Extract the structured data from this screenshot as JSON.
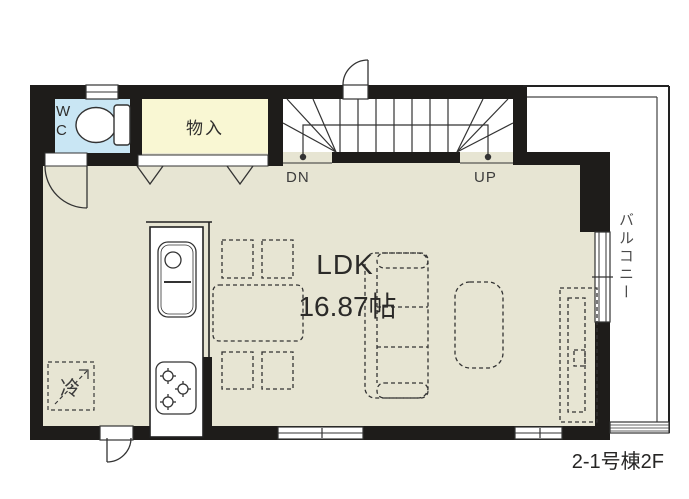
{
  "plan": {
    "unit_label": "2-1号棟2F",
    "rooms": {
      "wc": "WC",
      "storage": "物入",
      "ldk_name": "LDK",
      "ldk_size": "16.87帖",
      "balcony": "バルコニー",
      "refrigerator": "冷"
    },
    "stairs": {
      "down": "DN",
      "up": "UP"
    },
    "colors": {
      "wall": "#1e1c1a",
      "floor": "#e7e5d3",
      "wc_floor": "#c9e6f4",
      "storage_floor": "#f9f7d3",
      "line": "#333333",
      "background": "#ffffff"
    }
  }
}
